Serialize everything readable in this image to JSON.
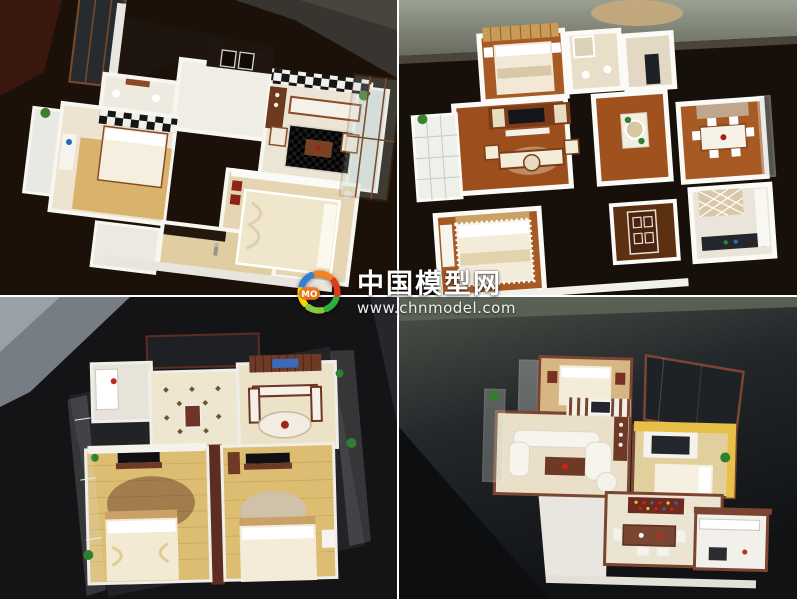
{
  "watermark": {
    "site_name": "中国模型网",
    "url": "www.chnmodel.com",
    "logo": {
      "text": "MO",
      "colors": {
        "blue": "#2f7fd4",
        "orange": "#f5821f",
        "red": "#e03a1c",
        "green": "#2fae3e",
        "lime": "#8cc63e",
        "yellow": "#ffd200",
        "badge": "#f07818"
      }
    }
  },
  "collage": {
    "rows": 2,
    "cols": 2,
    "divider_color": "#ffffff",
    "photos": [
      {
        "position": "top-left",
        "subject": "Scale model apartment, cream interior with checkered rug and walnut trim on dark brown table"
      },
      {
        "position": "top-right",
        "subject": "Scale model apartment, white walls with warm wood floors on black glass table"
      },
      {
        "position": "bottom-left",
        "subject": "Scale model apartment with acrylic walls, mahogany trim and twin yellow-floor bedrooms"
      },
      {
        "position": "bottom-right",
        "subject": "Scale model apartment with white curved sofa living room and amber bedroom on slate surface"
      }
    ]
  },
  "palette": {
    "table_dark_brown": "#1b1108",
    "table_black": "#141417",
    "table_slate_green": "#4c5348",
    "model_wall_white": "#f8f6f0",
    "wood_floor": "#a35a24",
    "mahogany_trim": "#5c2d20",
    "walnut_trim": "#7a4a2b",
    "cream_floor": "#ece2c8",
    "yellow_wood_floor": "#d9ba6e",
    "plant_green": "#2f8030"
  }
}
